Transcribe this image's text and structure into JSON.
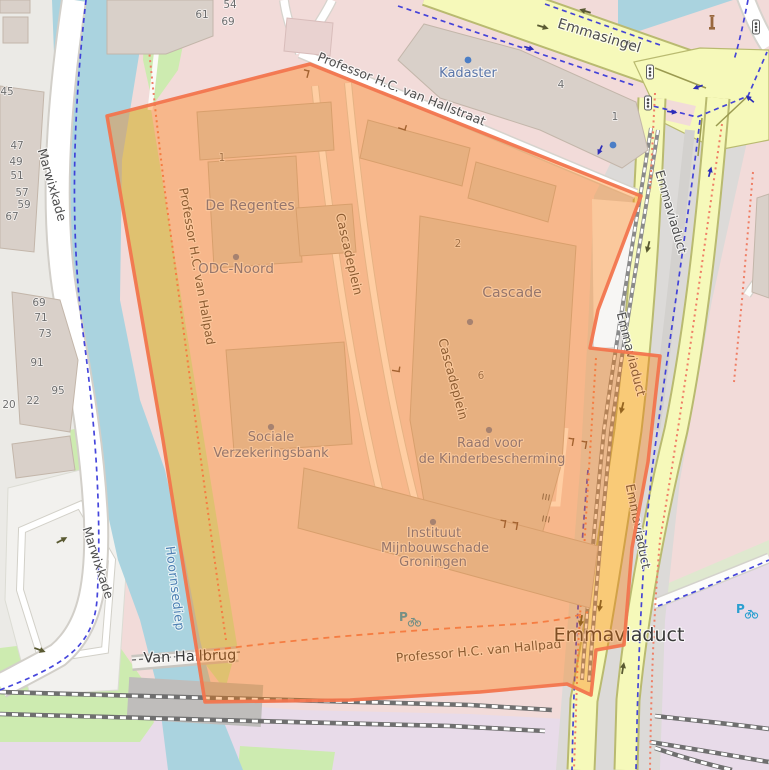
{
  "map": {
    "colors": {
      "water": "#aad3df",
      "grass": "#cdebb0",
      "residential": "#f2dbd9",
      "railway_landuse": "#e8dbe9",
      "road_yellow": "#f6f9ba",
      "road_casing": "#b9ba70",
      "building": "#d9d0c9",
      "overlay_fill": "#ff7800",
      "overlay_stroke": "#f2754e",
      "cycleway": "#3232d8",
      "footpath": "#ef7f66"
    },
    "labels": [
      {
        "n": "street-label-marwixkade-north",
        "t": "Marwixkade",
        "x": 48,
        "y": 186,
        "r": 74,
        "c": "street",
        "fs": 12.5
      },
      {
        "n": "street-label-marwixkade-south",
        "t": "Marwixkade",
        "x": 94,
        "y": 564,
        "r": 72,
        "c": "street",
        "fs": 12.5
      },
      {
        "n": "street-label-emmasingel",
        "t": "Emmasingel",
        "x": 598,
        "y": 40,
        "r": 17,
        "c": "street",
        "fs": 14
      },
      {
        "n": "street-label-hallstraat",
        "t": "Professor H.C. van Hallstraat",
        "x": 400,
        "y": 93,
        "r": 21.5,
        "c": "street",
        "fs": 12.5
      },
      {
        "n": "street-label-hallpad-west",
        "t": "Professor H.C. van Hallpad",
        "x": 193,
        "y": 267,
        "r": 80,
        "c": "street",
        "fs": 12
      },
      {
        "n": "street-label-hallpad-south",
        "t": "Professor H.C. van Hallpad",
        "x": 479,
        "y": 655,
        "r": -5,
        "c": "street",
        "fs": 12.5
      },
      {
        "n": "street-label-cascadeplein-north",
        "t": "Cascadeplein",
        "x": 345,
        "y": 255,
        "r": 77,
        "c": "street",
        "fs": 12.5
      },
      {
        "n": "street-label-cascadeplein-south",
        "t": "Cascadeplein",
        "x": 449,
        "y": 380,
        "r": 75,
        "c": "street",
        "fs": 12.5
      },
      {
        "n": "street-label-emmaviaduct-1",
        "t": "Emmaviaduct",
        "x": 667,
        "y": 213,
        "r": 74,
        "c": "street",
        "fs": 12.5
      },
      {
        "n": "street-label-emmaviaduct-2",
        "t": "Emmaviaduct",
        "x": 627,
        "y": 355,
        "r": 76,
        "c": "street",
        "fs": 12.5
      },
      {
        "n": "street-label-emmaviaduct-3",
        "t": "Emmaviaduct",
        "x": 634,
        "y": 527,
        "r": 79,
        "c": "street",
        "fs": 12.5
      },
      {
        "n": "street-label-emmaviaduct-big",
        "t": "Emmaviaduct",
        "x": 619,
        "y": 641,
        "r": 0,
        "c": "street-lg",
        "fs": 19
      },
      {
        "n": "bridge-label-van-hallbrug",
        "t": "Van Hallbrug",
        "x": 190,
        "y": 661,
        "r": -2,
        "c": "bridge",
        "fs": 14.5
      },
      {
        "n": "water-label-hoornsediep",
        "t": "Hoornsediep",
        "x": 171,
        "y": 589,
        "r": 83,
        "c": "water-lbl",
        "fs": 12.5
      },
      {
        "n": "poi-label-kadaster",
        "t": "Kadaster",
        "x": 468,
        "y": 77,
        "r": 0,
        "c": "poi",
        "fs": 13
      },
      {
        "n": "poi-label-de-regentes",
        "t": "De Regentes",
        "x": 250,
        "y": 210,
        "r": 0,
        "c": "poi",
        "fs": 14
      },
      {
        "n": "poi-label-odc-noord",
        "t": "ODC-Noord",
        "x": 236,
        "y": 273,
        "r": 0,
        "c": "poi",
        "fs": 13.5
      },
      {
        "n": "poi-label-cascade",
        "t": "Cascade",
        "x": 512,
        "y": 297,
        "r": 0,
        "c": "poi",
        "fs": 14
      },
      {
        "n": "poi-label-sociale-line1",
        "t": "Sociale",
        "x": 271,
        "y": 441,
        "r": 0,
        "c": "poi",
        "fs": 13
      },
      {
        "n": "poi-label-sociale-line2",
        "t": "Verzekeringsbank",
        "x": 271,
        "y": 457,
        "r": 0,
        "c": "poi",
        "fs": 13
      },
      {
        "n": "poi-label-raad-line1",
        "t": "Raad voor",
        "x": 490,
        "y": 447,
        "r": 0,
        "c": "poi",
        "fs": 13
      },
      {
        "n": "poi-label-raad-line2",
        "t": "de Kinderbescherming",
        "x": 492,
        "y": 463,
        "r": 0,
        "c": "poi",
        "fs": 13
      },
      {
        "n": "poi-label-instituut-line1",
        "t": "Instituut",
        "x": 434,
        "y": 537,
        "r": 0,
        "c": "poi",
        "fs": 13
      },
      {
        "n": "poi-label-instituut-line2",
        "t": "Mijnbouwschade",
        "x": 435,
        "y": 552,
        "r": 0,
        "c": "poi",
        "fs": 13
      },
      {
        "n": "poi-label-instituut-line3",
        "t": "Groningen",
        "x": 433,
        "y": 566,
        "r": 0,
        "c": "poi",
        "fs": 13
      }
    ],
    "house_numbers": [
      {
        "t": "61",
        "x": 202,
        "y": 18
      },
      {
        "t": "54",
        "x": 230,
        "y": 8
      },
      {
        "t": "69",
        "x": 228,
        "y": 25
      },
      {
        "t": "45",
        "x": 7,
        "y": 95
      },
      {
        "t": "47",
        "x": 17,
        "y": 149
      },
      {
        "t": "49",
        "x": 16,
        "y": 165
      },
      {
        "t": "51",
        "x": 17,
        "y": 179
      },
      {
        "t": "57",
        "x": 22,
        "y": 196
      },
      {
        "t": "59",
        "x": 24,
        "y": 208
      },
      {
        "t": "67",
        "x": 12,
        "y": 220
      },
      {
        "t": "69",
        "x": 39,
        "y": 306
      },
      {
        "t": "71",
        "x": 41,
        "y": 321
      },
      {
        "t": "73",
        "x": 45,
        "y": 337
      },
      {
        "t": "91",
        "x": 37,
        "y": 366
      },
      {
        "t": "95",
        "x": 58,
        "y": 394
      },
      {
        "t": "20",
        "x": 9,
        "y": 408
      },
      {
        "t": "22",
        "x": 33,
        "y": 404
      },
      {
        "t": "1",
        "x": 222,
        "y": 161
      },
      {
        "t": "4",
        "x": 561,
        "y": 88
      },
      {
        "t": "1",
        "x": 615,
        "y": 120
      },
      {
        "t": "2",
        "x": 458,
        "y": 247
      },
      {
        "t": "6",
        "x": 481,
        "y": 379
      }
    ],
    "icons": [
      {
        "type": "poi-dot",
        "x": 236,
        "y": 257,
        "rot": 0
      },
      {
        "type": "poi-dot",
        "x": 271,
        "y": 427,
        "rot": 0
      },
      {
        "type": "poi-dot",
        "x": 489,
        "y": 430,
        "rot": 0
      },
      {
        "type": "poi-dot",
        "x": 433,
        "y": 522,
        "rot": 0
      },
      {
        "type": "poi-dot",
        "x": 470,
        "y": 322,
        "rot": 0
      },
      {
        "type": "poi-dot-blue",
        "x": 468,
        "y": 60,
        "rot": 0
      },
      {
        "type": "poi-dot-blue",
        "x": 613,
        "y": 145,
        "rot": 0
      },
      {
        "type": "traffic-light-icon",
        "x": 650,
        "y": 72,
        "rot": 0
      },
      {
        "type": "traffic-light-icon",
        "x": 648,
        "y": 103,
        "rot": 0
      },
      {
        "type": "traffic-light-icon",
        "x": 756,
        "y": 27,
        "rot": 0
      },
      {
        "type": "monument-icon",
        "x": 712,
        "y": 24,
        "rot": 0
      },
      {
        "type": "bicycle-parking-icon",
        "x": 408,
        "y": 618,
        "rot": 0
      },
      {
        "type": "bicycle-parking-icon",
        "x": 745,
        "y": 610,
        "rot": 0
      },
      {
        "type": "gate-icon",
        "x": 308,
        "y": 74,
        "rot": 15
      },
      {
        "type": "gate-icon",
        "x": 402,
        "y": 129,
        "rot": 108
      },
      {
        "type": "gate-icon",
        "x": 573,
        "y": 442,
        "rot": 10
      },
      {
        "type": "gate-icon",
        "x": 586,
        "y": 445,
        "rot": 10
      },
      {
        "type": "gate-icon",
        "x": 505,
        "y": 524,
        "rot": 10
      },
      {
        "type": "gate-icon",
        "x": 517,
        "y": 526,
        "rot": 10
      },
      {
        "type": "gate-icon",
        "x": 396,
        "y": 371,
        "rot": 100
      },
      {
        "type": "stairs-icon",
        "x": 546,
        "y": 497,
        "rot": 100
      },
      {
        "type": "stairs-icon",
        "x": 546,
        "y": 519,
        "rot": 100
      },
      {
        "type": "oneway-arrow-icon",
        "x": 543,
        "y": 27,
        "rot": 17
      },
      {
        "type": "oneway-arrow-icon",
        "x": 629,
        "y": 43,
        "rot": 197
      },
      {
        "type": "oneway-arrow-icon",
        "x": 585,
        "y": 11,
        "rot": 197
      },
      {
        "type": "oneway-arrow-icon",
        "x": 648,
        "y": 247,
        "rot": 104
      },
      {
        "type": "oneway-arrow-icon",
        "x": 622,
        "y": 408,
        "rot": 104
      },
      {
        "type": "oneway-arrow-icon",
        "x": 600,
        "y": 606,
        "rot": 100
      },
      {
        "type": "oneway-arrow-icon",
        "x": 581,
        "y": 621,
        "rot": 100
      },
      {
        "type": "oneway-arrow-icon",
        "x": 623,
        "y": 668,
        "rot": -80
      },
      {
        "type": "oneway-arrow-icon",
        "x": 62,
        "y": 540,
        "rot": -28
      },
      {
        "type": "oneway-arrow-icon",
        "x": 40,
        "y": 650,
        "rot": 20
      },
      {
        "type": "cycle-arrow-icon",
        "x": 529,
        "y": 48,
        "rot": 17
      },
      {
        "type": "cycle-arrow-icon",
        "x": 600,
        "y": 150,
        "rot": 115
      },
      {
        "type": "cycle-arrow-icon",
        "x": 710,
        "y": 172,
        "rot": -75
      },
      {
        "type": "cycle-arrow-icon",
        "x": 698,
        "y": 87,
        "rot": 160
      },
      {
        "type": "cycle-arrow-icon",
        "x": 672,
        "y": 112,
        "rot": 8
      },
      {
        "type": "cycle-arrow-icon",
        "x": 750,
        "y": 99,
        "rot": -140
      }
    ]
  }
}
